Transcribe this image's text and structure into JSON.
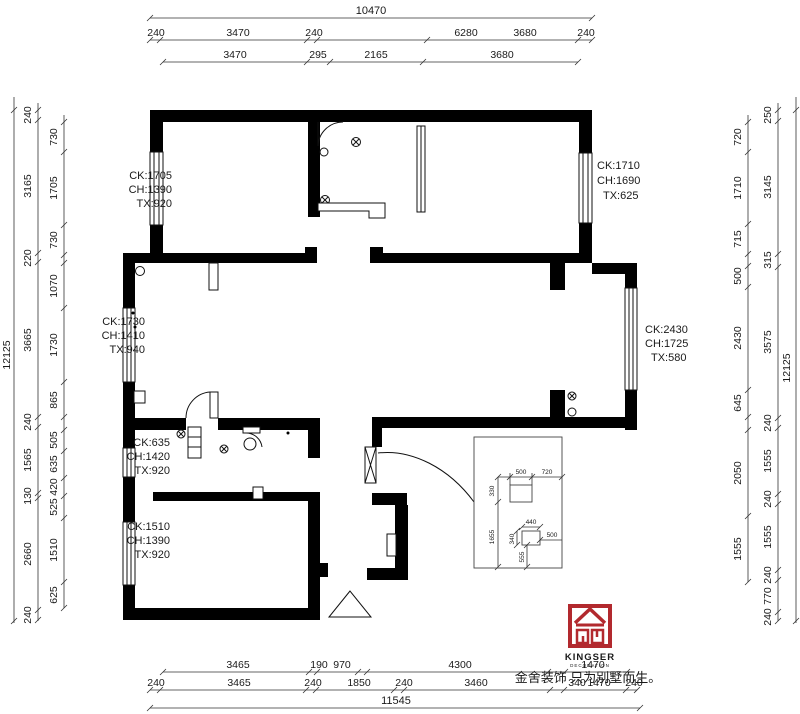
{
  "title": "Kingser floor plan drawing",
  "colors": {
    "wall": "#000000",
    "dim_line": "#333333",
    "logo_red": "#b2292e",
    "text": "#1a1a1a"
  },
  "logo": {
    "brand": "KINGSER",
    "sub": "DECORATION",
    "slogan": "金舍装饰 只为别墅而生。"
  },
  "dim_chains": [
    {
      "dir": "h",
      "y": 18,
      "x1": 150,
      "x2": 592,
      "ticks": [
        150,
        592
      ]
    },
    {
      "dir": "h",
      "y": 40,
      "x1": 150,
      "x2": 592,
      "ticks": [
        150,
        160,
        307,
        317,
        427,
        578,
        592
      ]
    },
    {
      "dir": "h",
      "y": 62,
      "x1": 163,
      "x2": 578,
      "ticks": [
        163,
        307,
        330,
        423,
        578
      ]
    },
    {
      "dir": "v",
      "x": 14,
      "y1": 97,
      "y2": 623,
      "ticks": [
        110,
        621
      ]
    },
    {
      "dir": "v",
      "x": 38,
      "y1": 103,
      "y2": 621,
      "ticks": [
        110,
        120,
        253,
        262,
        417,
        427,
        493,
        498,
        610,
        620
      ]
    },
    {
      "dir": "v",
      "x": 64,
      "y1": 115,
      "y2": 608,
      "ticks": [
        122,
        152,
        225,
        255,
        263,
        308,
        382,
        417,
        430,
        451,
        478,
        496,
        518,
        582,
        608
      ]
    },
    {
      "dir": "v",
      "x": 748,
      "y1": 115,
      "y2": 582,
      "ticks": [
        122,
        152,
        224,
        254,
        266,
        287,
        390,
        417,
        430,
        516,
        582
      ]
    },
    {
      "dir": "v",
      "x": 778,
      "y1": 103,
      "y2": 621,
      "ticks": [
        110,
        121,
        254,
        267,
        418,
        428,
        494,
        504,
        570,
        580,
        612,
        621
      ]
    },
    {
      "dir": "v",
      "x": 796,
      "y1": 97,
      "y2": 623,
      "ticks": [
        110,
        621
      ]
    },
    {
      "dir": "h",
      "y": 672,
      "x1": 163,
      "x2": 627,
      "ticks": [
        163,
        309,
        317,
        358,
        367,
        548,
        565,
        627
      ]
    },
    {
      "dir": "h",
      "y": 690,
      "x1": 150,
      "x2": 637,
      "ticks": [
        150,
        160,
        306,
        316,
        394,
        404,
        550,
        564,
        626,
        637
      ]
    },
    {
      "dir": "h",
      "y": 708,
      "x1": 150,
      "x2": 640,
      "ticks": [
        150,
        640
      ]
    },
    {
      "dir": "h",
      "y": 477,
      "x1": 498,
      "x2": 562,
      "ticks": [
        510,
        532,
        562
      ]
    },
    {
      "dir": "v",
      "x": 498,
      "y1": 477,
      "y2": 567,
      "ticks": [
        477,
        502,
        567
      ]
    },
    {
      "dir": "h",
      "y": 527,
      "x1": 522,
      "x2": 540,
      "ticks": [
        522,
        540
      ]
    },
    {
      "dir": "v",
      "x": 517,
      "y1": 531,
      "y2": 545,
      "ticks": [
        531,
        545
      ]
    },
    {
      "dir": "h",
      "y": 540,
      "x1": 540,
      "x2": 562,
      "ticks": [
        540
      ]
    },
    {
      "dir": "v",
      "x": 527,
      "y1": 545,
      "y2": 567,
      "ticks": [
        545,
        567
      ]
    }
  ],
  "labels": [
    {
      "t": "10470",
      "x": 371,
      "y": 14,
      "s": 11
    },
    {
      "t": "240",
      "x": 156,
      "y": 36
    },
    {
      "t": "3470",
      "x": 238,
      "y": 36
    },
    {
      "t": "240",
      "x": 314,
      "y": 36
    },
    {
      "t": "6280",
      "x": 466,
      "y": 36
    },
    {
      "t": "3680",
      "x": 525,
      "y": 36
    },
    {
      "t": "240",
      "x": 586,
      "y": 36
    },
    {
      "t": "3470",
      "x": 235,
      "y": 58
    },
    {
      "t": "295",
      "x": 318,
      "y": 58
    },
    {
      "t": "2165",
      "x": 376,
      "y": 58
    },
    {
      "t": "3680",
      "x": 502,
      "y": 58
    },
    {
      "t": "12125",
      "x": 10,
      "y": 355,
      "r": -90
    },
    {
      "t": "240",
      "x": 31,
      "y": 115,
      "r": -90
    },
    {
      "t": "3165",
      "x": 31,
      "y": 186,
      "r": -90
    },
    {
      "t": "220",
      "x": 31,
      "y": 258,
      "r": -90
    },
    {
      "t": "3665",
      "x": 31,
      "y": 340,
      "r": -90
    },
    {
      "t": "240",
      "x": 31,
      "y": 422,
      "r": -90
    },
    {
      "t": "1565",
      "x": 31,
      "y": 460,
      "r": -90
    },
    {
      "t": "130",
      "x": 31,
      "y": 496,
      "r": -90
    },
    {
      "t": "2660",
      "x": 31,
      "y": 554,
      "r": -90
    },
    {
      "t": "240",
      "x": 31,
      "y": 615,
      "r": -90
    },
    {
      "t": "730",
      "x": 57,
      "y": 137,
      "r": -90
    },
    {
      "t": "1705",
      "x": 57,
      "y": 188,
      "r": -90
    },
    {
      "t": "730",
      "x": 57,
      "y": 240,
      "r": -90
    },
    {
      "t": "1070",
      "x": 57,
      "y": 286,
      "r": -90
    },
    {
      "t": "1730",
      "x": 57,
      "y": 345,
      "r": -90
    },
    {
      "t": "865",
      "x": 57,
      "y": 400,
      "r": -90
    },
    {
      "t": "505",
      "x": 57,
      "y": 440,
      "r": -90
    },
    {
      "t": "635",
      "x": 57,
      "y": 464,
      "r": -90
    },
    {
      "t": "420",
      "x": 57,
      "y": 487,
      "r": -90
    },
    {
      "t": "525",
      "x": 57,
      "y": 507,
      "r": -90
    },
    {
      "t": "1510",
      "x": 57,
      "y": 550,
      "r": -90
    },
    {
      "t": "625",
      "x": 57,
      "y": 595,
      "r": -90
    },
    {
      "t": "720",
      "x": 741,
      "y": 137,
      "r": -90
    },
    {
      "t": "1710",
      "x": 741,
      "y": 188,
      "r": -90
    },
    {
      "t": "715",
      "x": 741,
      "y": 239,
      "r": -90
    },
    {
      "t": "500",
      "x": 741,
      "y": 276,
      "r": -90
    },
    {
      "t": "2430",
      "x": 741,
      "y": 338,
      "r": -90
    },
    {
      "t": "645",
      "x": 741,
      "y": 403,
      "r": -90
    },
    {
      "t": "2050",
      "x": 741,
      "y": 473,
      "r": -90
    },
    {
      "t": "1555",
      "x": 741,
      "y": 549,
      "r": -90
    },
    {
      "t": "250",
      "x": 771,
      "y": 115,
      "r": -90
    },
    {
      "t": "3145",
      "x": 771,
      "y": 187,
      "r": -90
    },
    {
      "t": "315",
      "x": 771,
      "y": 260,
      "r": -90
    },
    {
      "t": "3575",
      "x": 771,
      "y": 342,
      "r": -90
    },
    {
      "t": "240",
      "x": 771,
      "y": 423,
      "r": -90
    },
    {
      "t": "1555",
      "x": 771,
      "y": 461,
      "r": -90
    },
    {
      "t": "240",
      "x": 771,
      "y": 499,
      "r": -90
    },
    {
      "t": "1555",
      "x": 771,
      "y": 537,
      "r": -90
    },
    {
      "t": "240",
      "x": 771,
      "y": 575,
      "r": -90
    },
    {
      "t": "770",
      "x": 771,
      "y": 596,
      "r": -90
    },
    {
      "t": "240",
      "x": 771,
      "y": 617,
      "r": -90
    },
    {
      "t": "12125",
      "x": 790,
      "y": 368,
      "r": -90
    },
    {
      "t": "3465",
      "x": 238,
      "y": 668
    },
    {
      "t": "190",
      "x": 319,
      "y": 668
    },
    {
      "t": "970",
      "x": 342,
      "y": 668
    },
    {
      "t": "4300",
      "x": 460,
      "y": 668
    },
    {
      "t": "1470",
      "x": 593,
      "y": 668
    },
    {
      "t": "240",
      "x": 156,
      "y": 686
    },
    {
      "t": "3465",
      "x": 239,
      "y": 686
    },
    {
      "t": "240",
      "x": 313,
      "y": 686
    },
    {
      "t": "1850",
      "x": 359,
      "y": 686
    },
    {
      "t": "240",
      "x": 404,
      "y": 686
    },
    {
      "t": "3460",
      "x": 476,
      "y": 686
    },
    {
      "t": "340",
      "x": 577,
      "y": 686
    },
    {
      "t": "1470",
      "x": 599,
      "y": 686
    },
    {
      "t": "240",
      "x": 634,
      "y": 686
    },
    {
      "t": "11545",
      "x": 396,
      "y": 704,
      "s": 11
    },
    {
      "t": "CK:1705",
      "x": 172,
      "y": 179,
      "s": 11,
      "a": "end",
      "n": "window-spec"
    },
    {
      "t": "CH:1390",
      "x": 172,
      "y": 193,
      "s": 11,
      "a": "end",
      "n": "window-spec"
    },
    {
      "t": "TX:920",
      "x": 172,
      "y": 207,
      "s": 11,
      "a": "end",
      "n": "window-spec"
    },
    {
      "t": "CK:1710",
      "x": 597,
      "y": 169,
      "s": 11,
      "a": "start",
      "n": "window-spec"
    },
    {
      "t": "CH:1690",
      "x": 597,
      "y": 184,
      "s": 11,
      "a": "start",
      "n": "window-spec"
    },
    {
      "t": "TX:625",
      "x": 603,
      "y": 199,
      "s": 11,
      "a": "start",
      "n": "window-spec"
    },
    {
      "t": "CK:1730",
      "x": 145,
      "y": 325,
      "s": 11,
      "a": "end",
      "n": "window-spec"
    },
    {
      "t": "CH:1410",
      "x": 145,
      "y": 339,
      "s": 11,
      "a": "end",
      "n": "window-spec"
    },
    {
      "t": "TX:940",
      "x": 145,
      "y": 353,
      "s": 11,
      "a": "end",
      "n": "window-spec"
    },
    {
      "t": "CK:2430",
      "x": 645,
      "y": 333,
      "s": 11,
      "a": "start",
      "n": "window-spec"
    },
    {
      "t": "CH:1725",
      "x": 645,
      "y": 347,
      "s": 11,
      "a": "start",
      "n": "window-spec"
    },
    {
      "t": "TX:580",
      "x": 651,
      "y": 361,
      "s": 11,
      "a": "start",
      "n": "window-spec"
    },
    {
      "t": "CK:635",
      "x": 170,
      "y": 446,
      "s": 11,
      "a": "end",
      "n": "window-spec"
    },
    {
      "t": "CH:1420",
      "x": 170,
      "y": 460,
      "s": 11,
      "a": "end",
      "n": "window-spec"
    },
    {
      "t": "TX:920",
      "x": 170,
      "y": 474,
      "s": 11,
      "a": "end",
      "n": "window-spec"
    },
    {
      "t": "CK:1510",
      "x": 170,
      "y": 530,
      "s": 11,
      "a": "end",
      "n": "window-spec"
    },
    {
      "t": "CH:1390",
      "x": 170,
      "y": 544,
      "s": 11,
      "a": "end",
      "n": "window-spec"
    },
    {
      "t": "TX:920",
      "x": 170,
      "y": 558,
      "s": 11,
      "a": "end",
      "n": "window-spec"
    },
    {
      "t": "500",
      "x": 521,
      "y": 474,
      "s": 6.5,
      "n": "inset-dim"
    },
    {
      "t": "720",
      "x": 547,
      "y": 474,
      "s": 6.5,
      "n": "inset-dim"
    },
    {
      "t": "440",
      "x": 531,
      "y": 524,
      "s": 6.5,
      "n": "inset-dim"
    },
    {
      "t": "500",
      "x": 552,
      "y": 537,
      "s": 6.5,
      "n": "inset-dim"
    },
    {
      "t": "330",
      "x": 494,
      "y": 491,
      "s": 6.5,
      "r": -90,
      "n": "inset-dim"
    },
    {
      "t": "1655",
      "x": 494,
      "y": 537,
      "s": 6.5,
      "r": -90,
      "n": "inset-dim"
    },
    {
      "t": "340",
      "x": 514,
      "y": 539,
      "s": 6.5,
      "r": -90,
      "n": "inset-dim"
    },
    {
      "t": "555",
      "x": 524,
      "y": 557,
      "s": 6.5,
      "r": -90,
      "n": "inset-dim"
    }
  ]
}
